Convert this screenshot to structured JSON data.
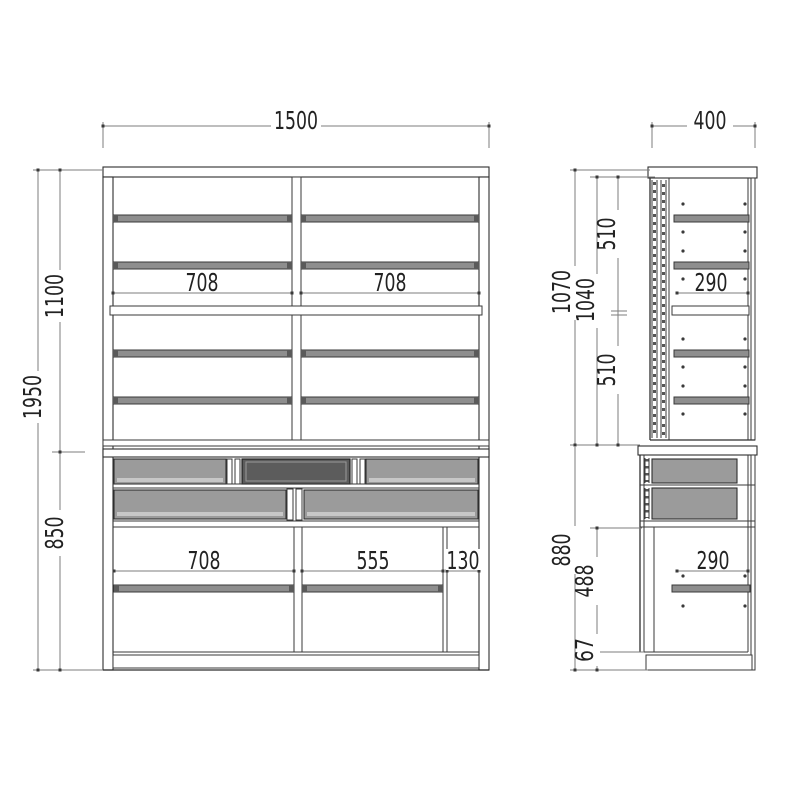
{
  "drawing": {
    "title": "cabinet-dimension-drawing",
    "colors": {
      "background": "#ffffff",
      "object_line": "#2f2f2f",
      "dimension_line": "#7d7d7d",
      "text": "#222222",
      "shelf_fill": "#8e8e8e",
      "drawer_fill": "#9b9b9b",
      "drawer_dark_fill": "#5c5c5c"
    },
    "front": {
      "overall_width": "1500",
      "overall_height": "1950",
      "upper_height": "1100",
      "lower_height": "850",
      "upper_left_width": "708",
      "upper_right_width": "708",
      "lower_left_width": "708",
      "lower_middle_width": "555",
      "lower_right_width": "130"
    },
    "side": {
      "overall_depth": "400",
      "upper_unit_height": "1070",
      "upper_inner_height": "1040",
      "upper_span_top": "510",
      "upper_span_bottom": "510",
      "upper_shelf_depth": "290",
      "lower_unit_height": "880",
      "lower_inner_height": "488",
      "base_height": "67",
      "lower_shelf_depth": "290"
    }
  }
}
